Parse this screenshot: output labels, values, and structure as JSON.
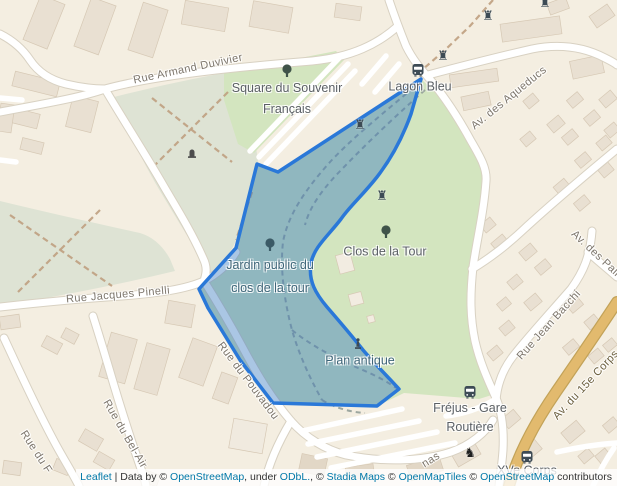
{
  "map_labels": {
    "streets": {
      "armand_duvivier": "Rue Armand Duvivier",
      "aqueducs": "Av. des Aqueducs",
      "jacques_pinelli": "Rue Jacques Pinelli",
      "pouvadou": "Rue du Pouvadou",
      "bel_air": "Rue du Bel-Air",
      "rue_du_f": "Rue du F",
      "jean_bacchi": "Rue Jean Bacchi",
      "corps_15e": "Av. du 15e Corps",
      "palmiers": "Av. des Palm",
      "nas_fragment": "nas"
    },
    "pois": {
      "square_souvenir": {
        "line1": "Square du Souvenir",
        "line2": "Français"
      },
      "lagon_bleu": "Lagon Bleu",
      "clos_de_la_tour": "Clos de la Tour",
      "jardin_public": {
        "line1": "Jardin public du",
        "line2": "clos de la tour"
      },
      "plan_antique": "Plan antique",
      "frejus_gare": {
        "line1": "Fréjus - Gare",
        "line2": "Routière"
      },
      "xve_corps": "XVe Corps"
    }
  },
  "icons": {
    "castle_glyph": "♜",
    "animal_glyph": "♞",
    "names": [
      "tree-icon",
      "bus-stop-icon",
      "castle-ruin-icon",
      "monument-icon",
      "statue-icon",
      "animal-icon"
    ]
  },
  "attribution": {
    "leaflet": "Leaflet",
    "sep": " | ",
    "databy": "Data by © ",
    "osm1": "OpenStreetMap",
    "under": ", under ",
    "odbl": "ODbL.",
    "c1": ", © ",
    "stadia": "Stadia Maps",
    "c2": " © ",
    "omt": "OpenMapTiles",
    "c3": " © ",
    "osm2": "OpenStreetMap",
    "contributors": " contributors"
  },
  "colors": {
    "land": "#f4eee1",
    "building": "#e9e0d2",
    "building_border": "#d6c8b4",
    "road": "#ffffff",
    "road_casing": "#d8d1c2",
    "park_green": "#d3e5bf",
    "archaeo_green": "#dee3d4",
    "path_brown": "#bf9f7f",
    "path_gray": "#949e99",
    "major_road_orange": "#e2ba6e",
    "selection_stroke": "#2a78d8",
    "selection_fill": "rgba(52,118,190,0.42)",
    "poi_label": "#5b6065",
    "street_label": "#7d766c",
    "overlay_tinted_label": "#3e6578",
    "attribution_link": "#0078a8"
  }
}
